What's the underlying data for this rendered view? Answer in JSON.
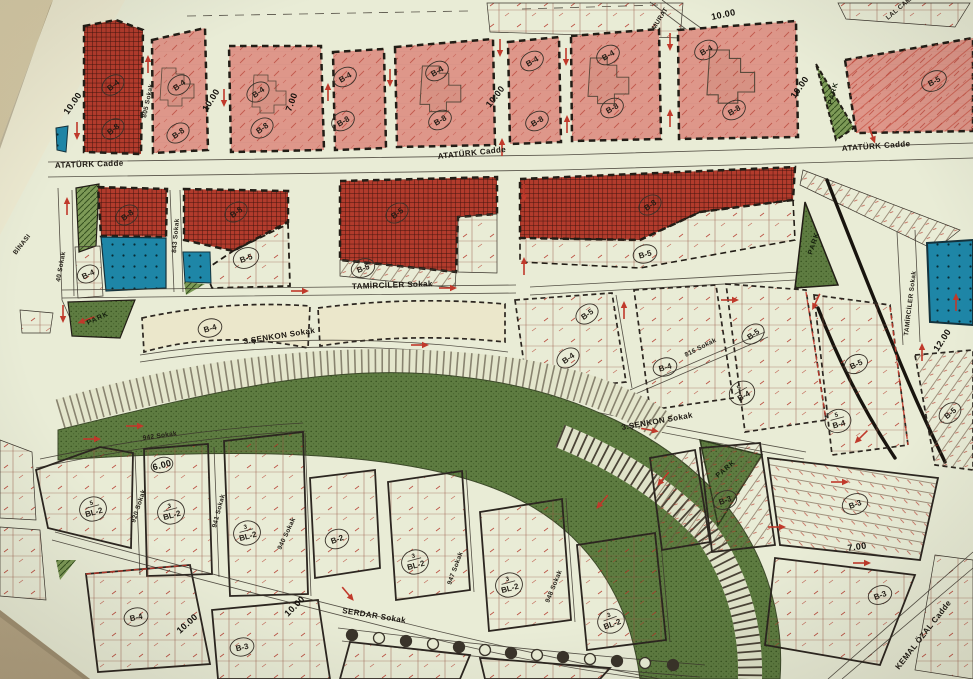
{
  "map": {
    "streets": {
      "ataturk": "ATATÜRK Cadde",
      "tamirciler": "TAMİRCİLER Sokak",
      "senkon": "3.ŞENKON Sokak",
      "serdar": "SERDAR Sokak",
      "kemal_ozal": "KEMAL ÖZAL Cadde",
      "murat": "MURAT",
      "lal_camii": "LAL CAMİİ",
      "binasi": "BİNASI",
      "s40": "40 Sokak",
      "s805": "805 Sokak",
      "s816": "816 Sokak",
      "s843": "843 Sokak",
      "s920": "920 Sokak",
      "s940": "940 Sokak",
      "s941": "941 Sokak",
      "s942": "942 Sokak",
      "s947": "947 Sokak",
      "s948": "948 Sokak"
    },
    "zones": {
      "b2": "B-2",
      "b3": "B-3",
      "b4": "B-4",
      "b5": "B-5",
      "b8": "B-8",
      "bl2": "BL-2"
    },
    "floors": {
      "f3": "3",
      "f5": "5"
    },
    "park": "PARK",
    "dims": {
      "w6": "6.00",
      "w7": "7.00",
      "w10": "10.00",
      "w12": "12.00"
    },
    "colors": {
      "paper": "#e9ecd6",
      "desk": "#b8a887",
      "residential_pink": "#de978a",
      "commercial_red_hatch": "#b23b2c",
      "institution_blue": "#1e86a7",
      "park_green": "#5e7c41",
      "annotation_red": "#c0392b",
      "line_black": "#221d16"
    }
  }
}
